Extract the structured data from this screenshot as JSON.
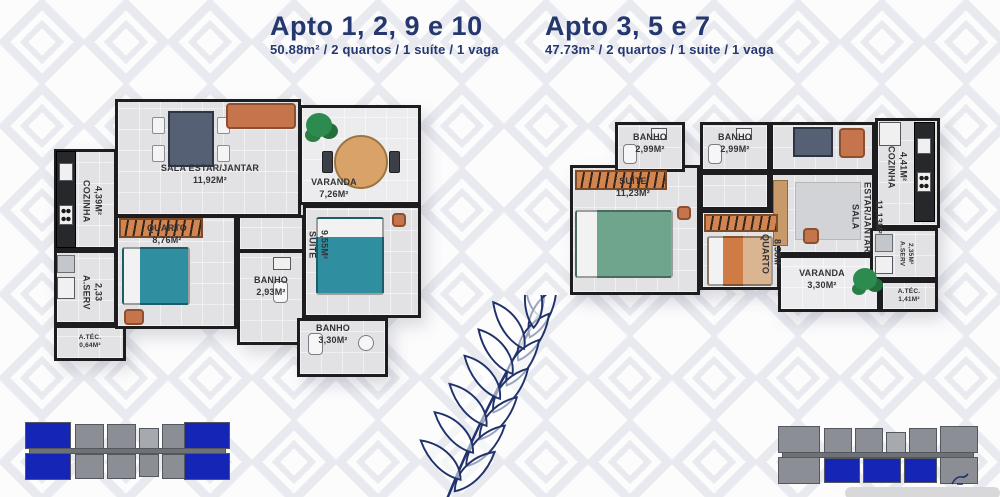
{
  "colors": {
    "title_navy": "#24376e",
    "wall": "#1d1d1f",
    "floor": "#e2e2e4",
    "furniture_orange": "#d28550",
    "sofa_orange": "#c5744b",
    "bed_teal": "#2f8fa0",
    "bed_green": "#6fa58c",
    "wood": "#d9a268",
    "keyplan_gray": "#8b8e94",
    "keyplan_blue": "#1525b5",
    "fern_blue": "#20326b",
    "pattern_gray": "#e8eaef"
  },
  "plans": [
    {
      "title": "Apto 1, 2, 9 e 10",
      "subtitle": "50.88m² / 2 quartos / 1 suíte / 1 vaga",
      "rooms": {
        "sala": {
          "name": "SALA ESTAR/JANTAR",
          "area": "11,92M²"
        },
        "varanda": {
          "name": "VARANDA",
          "area": "7,26M²"
        },
        "cozinha": {
          "name": "COZINHA",
          "area": "4,39M²"
        },
        "aserv": {
          "name": "A.SERV",
          "area": "2,33"
        },
        "atec": {
          "name": "A.TÉC.",
          "area": "0,64M²"
        },
        "quarto": {
          "name": "QUARTO",
          "area": "8,76M²"
        },
        "suite": {
          "name": "SUÍTE",
          "area": "9,55M²"
        },
        "banho1": {
          "name": "BANHO",
          "area": "2,93M²"
        },
        "banho2": {
          "name": "BANHO",
          "area": "3,30M²"
        }
      }
    },
    {
      "title": "Apto 3, 5 e 7",
      "subtitle": "47.73m² / 2 quartos / 1 suite / 1 vaga",
      "rooms": {
        "banho1": {
          "name": "BANHO",
          "area": "2,99M²"
        },
        "banho2": {
          "name": "BANHO",
          "area": "2,99M²"
        },
        "suite": {
          "name": "SUÍTE",
          "area": "11,23M²"
        },
        "sala": {
          "name": "SALA ESTAR/JANTAR",
          "area": "11,13M²"
        },
        "cozinha": {
          "name": "COZINHA",
          "area": "4,41M²"
        },
        "quarto": {
          "name": "QUARTO",
          "area": "8,58M²"
        },
        "varanda": {
          "name": "VARANDA",
          "area": "3,30M²"
        },
        "aserv": {
          "name": "A.SERV",
          "area": "2,35M²"
        },
        "atec": {
          "name": "A.TÉC.",
          "area": "1,41M²"
        }
      }
    }
  ]
}
